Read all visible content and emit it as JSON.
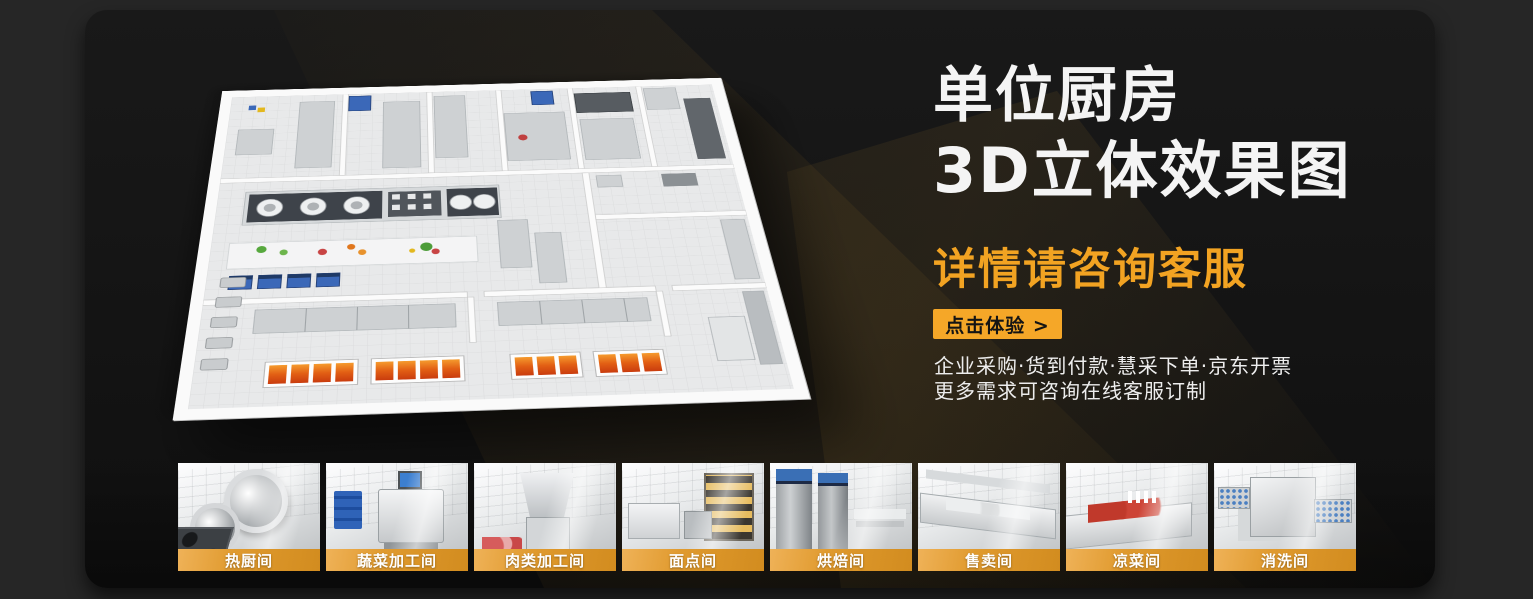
{
  "hero": {
    "title_line1": "单位厨房",
    "title_line2": "3D立体效果图",
    "subtitle": "详情请咨询客服",
    "cta_label": "点击体验 >",
    "features_line1": "企业采购·货到付款·慧采下单·京东开票",
    "features_line2": "更多需求可咨询在线客服订制"
  },
  "colors": {
    "accent_orange": "#f5a728",
    "subtitle_orange": "#f2a322",
    "thumbnail_band_orange": "#e09a2e",
    "panel_background": "#141414",
    "outer_background": "#262626",
    "title_white": "#f4f4f4"
  },
  "thumbnails": [
    {
      "label": "热厨间"
    },
    {
      "label": "蔬菜加工间"
    },
    {
      "label": "肉类加工间"
    },
    {
      "label": "面点间"
    },
    {
      "label": "烘焙间"
    },
    {
      "label": "售卖间"
    },
    {
      "label": "凉菜间"
    },
    {
      "label": "消洗间"
    }
  ]
}
